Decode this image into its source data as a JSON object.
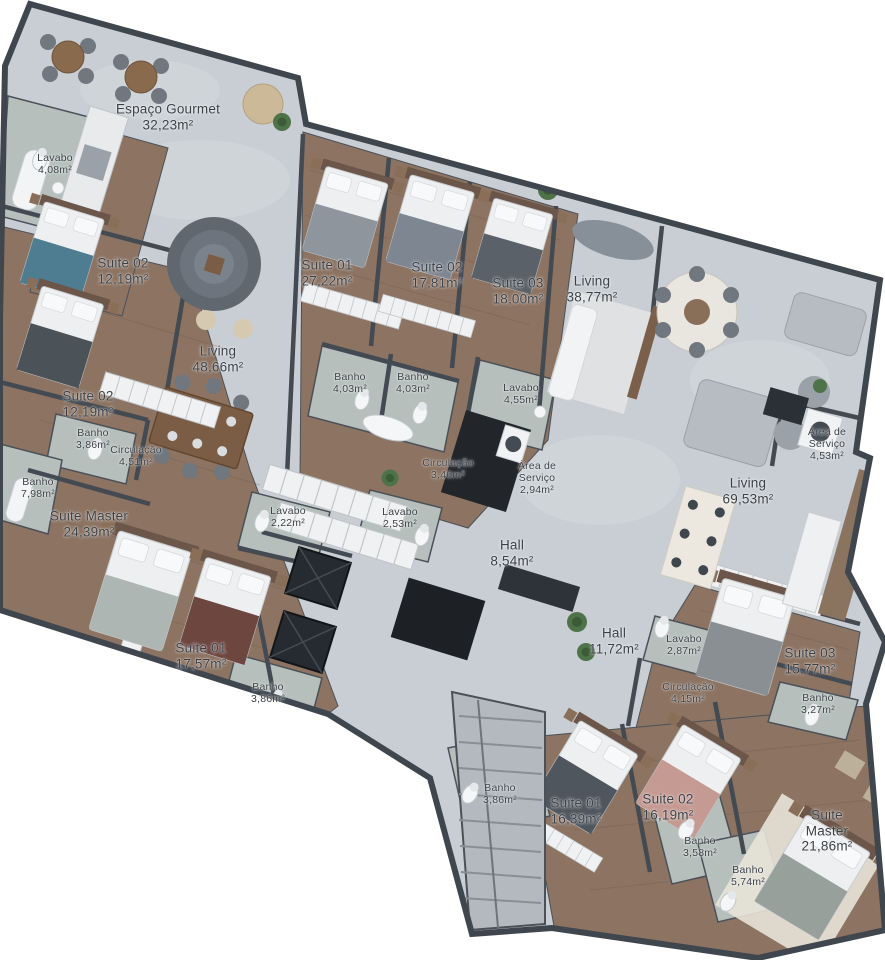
{
  "plan": {
    "type": "residential-floor-plan",
    "language": "pt-BR"
  },
  "colors": {
    "background": "#ffffff",
    "wall": "#3f464e",
    "floor_marble": "#c9ced4",
    "floor_wood": "#8c7362",
    "floor_bath": "#b6bfbc",
    "label_text": "#3b4046",
    "plant_green": "#4f7348",
    "core_dark": "#22262b"
  },
  "rooms": [
    {
      "id": "espaco-gourmet",
      "name": "Espaço Gourmet",
      "area": "32,23m²",
      "x": 168,
      "y": 117,
      "size": "lg"
    },
    {
      "id": "lavabo-408",
      "name": "Lavabo",
      "area": "4,08m²",
      "x": 55,
      "y": 164,
      "size": "sm"
    },
    {
      "id": "suite02-1219-a",
      "name": "Suite 02",
      "area": "12,19m²",
      "x": 123,
      "y": 271,
      "size": "lg"
    },
    {
      "id": "suite02-1219-b",
      "name": "Suite 02",
      "area": "12,19m²",
      "x": 88,
      "y": 404,
      "size": "lg"
    },
    {
      "id": "banho-386-a",
      "name": "Banho",
      "area": "3,86m²",
      "x": 93,
      "y": 439,
      "size": "sm"
    },
    {
      "id": "circulacao-451",
      "name": "Circulação",
      "area": "4,51m²",
      "x": 136,
      "y": 456,
      "size": "sm"
    },
    {
      "id": "banho-798",
      "name": "Banho",
      "area": "7,98m²",
      "x": 38,
      "y": 488,
      "size": "sm"
    },
    {
      "id": "suite-master-2439",
      "name": "Suite Master",
      "area": "24,39m²",
      "x": 89,
      "y": 524,
      "size": "lg"
    },
    {
      "id": "suite01-2722",
      "name": "Suite 01",
      "area": "27,22m²",
      "x": 327,
      "y": 273,
      "size": "lg"
    },
    {
      "id": "suite02-1781",
      "name": "Suite 02",
      "area": "17,81m²",
      "x": 437,
      "y": 275,
      "size": "lg"
    },
    {
      "id": "suite03-1800",
      "name": "Suite 03",
      "area": "18,00m²",
      "x": 518,
      "y": 291,
      "size": "lg"
    },
    {
      "id": "living-3877",
      "name": "Living",
      "area": "38,77m²",
      "x": 592,
      "y": 289,
      "size": "lg"
    },
    {
      "id": "living-4866",
      "name": "Living",
      "area": "48,66m²",
      "x": 218,
      "y": 359,
      "size": "lg"
    },
    {
      "id": "banho-403-a",
      "name": "Banho",
      "area": "4,03m²",
      "x": 350,
      "y": 383,
      "size": "sm"
    },
    {
      "id": "banho-403-b",
      "name": "Banho",
      "area": "4,03m²",
      "x": 413,
      "y": 383,
      "size": "sm"
    },
    {
      "id": "lavabo-455",
      "name": "Lavabo",
      "area": "4,55m²",
      "x": 521,
      "y": 394,
      "size": "sm"
    },
    {
      "id": "circulacao-346",
      "name": "Circulação",
      "area": "3,46m²",
      "x": 448,
      "y": 469,
      "size": "sm"
    },
    {
      "id": "area-servico-294",
      "name": "Área de Serviço",
      "area": "2,94m²",
      "x": 537,
      "y": 478,
      "size": "sm",
      "wrap": true
    },
    {
      "id": "lavabo-253",
      "name": "Lavabo",
      "area": "2,53m²",
      "x": 400,
      "y": 518,
      "size": "sm"
    },
    {
      "id": "lavabo-222",
      "name": "Lavabo",
      "area": "2,22m²",
      "x": 288,
      "y": 517,
      "size": "sm"
    },
    {
      "id": "hall-854",
      "name": "Hall",
      "area": "8,54m²",
      "x": 512,
      "y": 553,
      "size": "lg"
    },
    {
      "id": "area-servico-453",
      "name": "Área de Serviço",
      "area": "4,53m²",
      "x": 827,
      "y": 444,
      "size": "sm",
      "wrap": true
    },
    {
      "id": "living-6953",
      "name": "Living",
      "area": "69,53m²",
      "x": 748,
      "y": 491,
      "size": "lg"
    },
    {
      "id": "suite01-1757",
      "name": "Suite 01",
      "area": "17,57m²",
      "x": 201,
      "y": 656,
      "size": "lg"
    },
    {
      "id": "banho-386-b",
      "name": "Banho",
      "area": "3,86m²",
      "x": 268,
      "y": 693,
      "size": "sm"
    },
    {
      "id": "hall-1172",
      "name": "Hall",
      "area": "11,72m²",
      "x": 614,
      "y": 641,
      "size": "lg"
    },
    {
      "id": "lavabo-287",
      "name": "Lavabo",
      "area": "2,87m²",
      "x": 684,
      "y": 645,
      "size": "sm"
    },
    {
      "id": "circulacao-415",
      "name": "Circulação",
      "area": "4,15m²",
      "x": 688,
      "y": 693,
      "size": "sm"
    },
    {
      "id": "suite03-1577",
      "name": "Suite 03",
      "area": "15,77m²",
      "x": 810,
      "y": 661,
      "size": "lg"
    },
    {
      "id": "banho-327",
      "name": "Banho",
      "area": "3,27m²",
      "x": 818,
      "y": 704,
      "size": "sm"
    },
    {
      "id": "banho-386-c",
      "name": "Banho",
      "area": "3,86m²",
      "x": 500,
      "y": 794,
      "size": "sm"
    },
    {
      "id": "suite01-1639",
      "name": "Suite 01",
      "area": "16,39m²",
      "x": 576,
      "y": 811,
      "size": "lg"
    },
    {
      "id": "suite02-1619",
      "name": "Suite 02",
      "area": "16,19m²",
      "x": 668,
      "y": 807,
      "size": "lg"
    },
    {
      "id": "banho-358",
      "name": "Banho",
      "area": "3,58m²",
      "x": 700,
      "y": 847,
      "size": "sm"
    },
    {
      "id": "banho-574",
      "name": "Banho",
      "area": "5,74m²",
      "x": 748,
      "y": 876,
      "size": "sm"
    },
    {
      "id": "suite-master-2186",
      "name": "Suite Master",
      "area": "21,86m²",
      "x": 827,
      "y": 831,
      "size": "lg"
    }
  ]
}
